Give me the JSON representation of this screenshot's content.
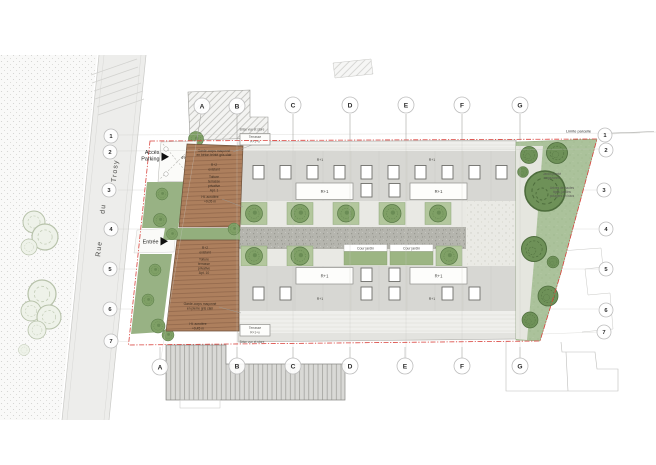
{
  "colors": {
    "boundary_red": "#d9423c",
    "deck_brown": "#ad7f5d",
    "garden_green": "#aac29a",
    "tree_green": "#7fa066",
    "building_gray": "#d7d7d3",
    "street_gray": "#ededeb"
  },
  "street": {
    "name_word1": "Rue",
    "name_word2": "du",
    "name_word3": "Trosy"
  },
  "grid": {
    "letters": [
      "A",
      "B",
      "C",
      "D",
      "E",
      "F",
      "G"
    ],
    "numbers": [
      "1",
      "2",
      "3",
      "4",
      "5",
      "6",
      "7"
    ]
  },
  "boundary": {
    "label": "Limite parcelle"
  },
  "access": {
    "parking_line1": "Accès",
    "parking_line2": "Parking",
    "ramp_slope": "4%",
    "entrance": "Entrée"
  },
  "building": {
    "roof_level": "R+1",
    "terrace_line1": "Terrasse",
    "terrace_line2": "R+1+u",
    "screen_note": "Brise vue et store"
  },
  "deck_upper": {
    "guard_line1": "Garde-corps maçonné",
    "guard_line2": "en béton teinté gris clair",
    "level_line1": "R+2",
    "level_line2": "existant",
    "roof_line1": "Toiture",
    "roof_line2": "terrasse",
    "roof_line3": "privative",
    "roof_line4": "Apt. 1",
    "height_line1": "Ht. acrotère",
    "height_line2": "+9,05 m"
  },
  "deck_lower": {
    "level_line1": "R+2",
    "level_line2": "existant",
    "roof_line1": "Toiture",
    "roof_line2": "terrasse",
    "roof_line3": "privative",
    "roof_line4": "Apt. 10",
    "guard_line1": "Garde-corps maçonné",
    "guard_line2": "en pierre gris clair",
    "height_line1": "Ht. acrotère",
    "height_line2": "+9,45 m"
  },
  "courtyard": {
    "strip1_label": "Cour jardin",
    "strip2_label": "Cour jardin"
  },
  "garden": {
    "note1_line1": "Jardin planté",
    "note1_line2": "engazonné",
    "note2_line1": "Arbres de hautes",
    "note2_line2": "tiges, jardins",
    "note2_line3": "potagers en bacs"
  }
}
